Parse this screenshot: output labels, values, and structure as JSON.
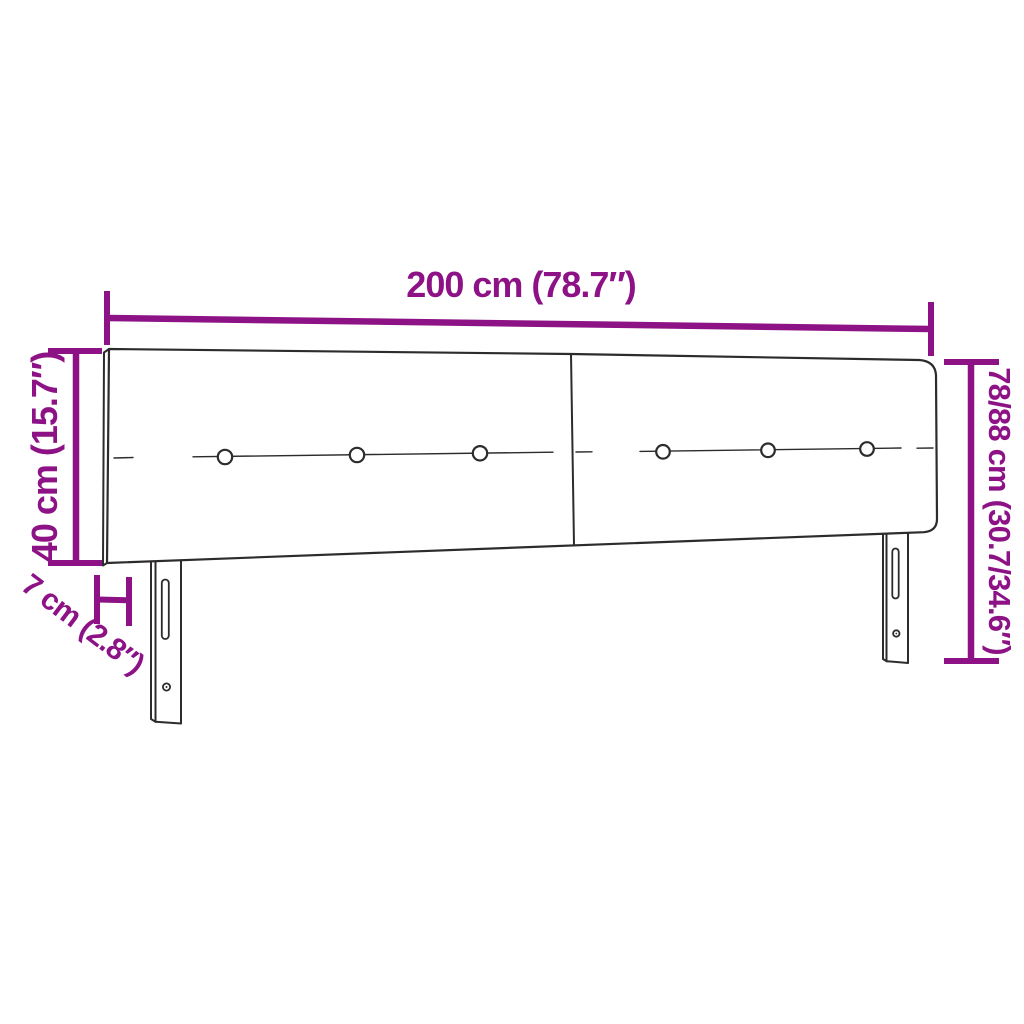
{
  "diagram": {
    "background_color": "#ffffff",
    "line_color": "#2e2b2c",
    "accent_color": "#8D1286",
    "panels_count": 2,
    "buttons_count": 6,
    "legs_count": 2,
    "dimensions": {
      "width": {
        "label": "200 cm (78.7″)",
        "value_cm": 200,
        "value_in": 78.7
      },
      "panel_height": {
        "label": "40 cm (15.7″)",
        "value_cm": 40,
        "value_in": 15.7
      },
      "thickness": {
        "label": "7 cm (2.8″)",
        "value_cm": 7,
        "value_in": 2.8
      },
      "total_height": {
        "label": "78/88 cm (30.7/34.6″)",
        "value_cm": "78/88",
        "value_in": "30.7/34.6"
      }
    }
  }
}
